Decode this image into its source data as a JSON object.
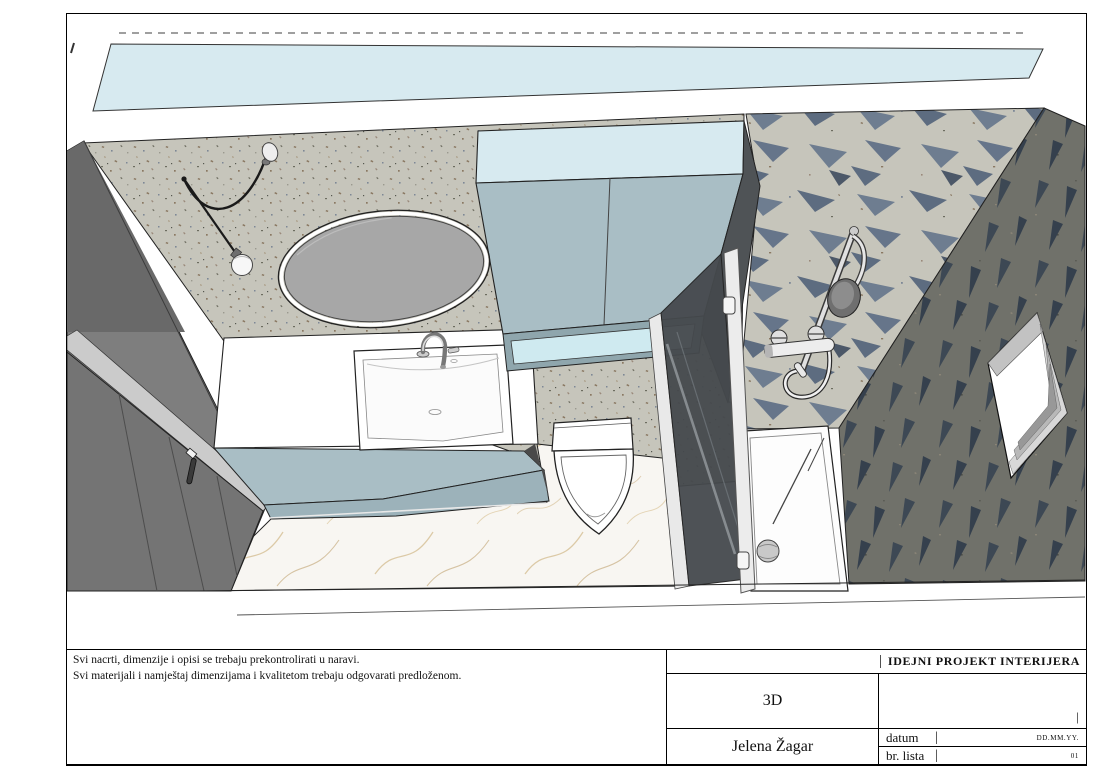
{
  "sheet": {
    "notes": {
      "line1": "Svi nacrti, dimenzije i opisi se trebaju prekontrolirati u naravi.",
      "line2": "Svi materijali i namještaj dimenzijama i kvalitetom trebaju odgovarati predloženom."
    },
    "title_block": {
      "project_title": "IDEJNI PROJEKT INTERIJERA",
      "separator": "|",
      "sheet_name": "3D",
      "author": "Jelena Žagar",
      "date_label": "datum",
      "date_value": "DD.MM.YY.",
      "sheet_number_label": "br. lista",
      "sheet_number_value": "01"
    }
  },
  "drawing": {
    "description": "Top-down 3D rendering of a bathroom interior",
    "elements": [
      "ceiling strip",
      "terrazzo wall",
      "entry door",
      "round mirror",
      "pendant lamp",
      "vanity with washbasin",
      "tall storage cabinet",
      "wall-hung toilet",
      "marble floor",
      "shower glass door",
      "shower tray with drain",
      "rain shower set",
      "patterned feature wall",
      "window opening"
    ]
  },
  "colors": {
    "ceiling-blue": "#d7eaf0",
    "cabinet-blue": "#a9bec5",
    "cabinet-blue-dark": "#9cb2ba",
    "niche-blue": "#cfeaf0",
    "terrazzo-base": "#c6c5bb",
    "pattern-triangle": "#6e7d90",
    "dark-wall": "#70716a",
    "dark-wall-triangle": "#3d4854",
    "door-gray": "#7e7e7e",
    "marble": "#f8f6f2",
    "mirror-gray": "#a7a7a7",
    "glass-dark": "#45494d",
    "line-black": "#1a1a1a"
  }
}
